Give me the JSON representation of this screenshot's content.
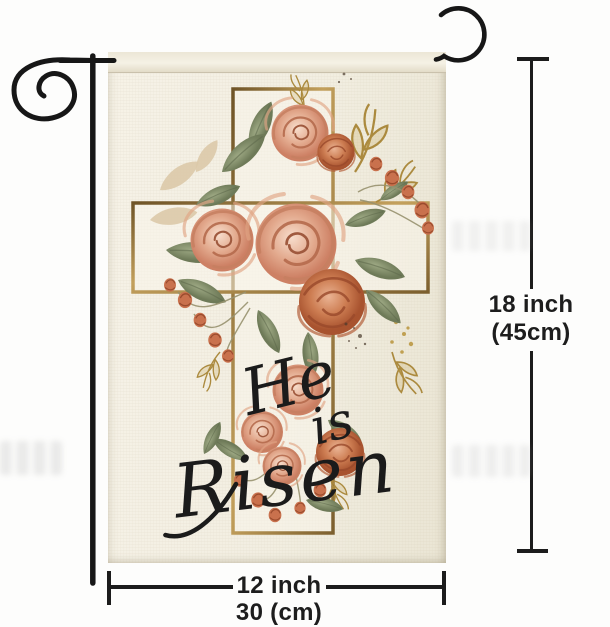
{
  "product": {
    "type": "garden-flag-with-stand",
    "flag_text": {
      "line1": "He",
      "line2": "is",
      "line3": "Risen"
    },
    "artwork": "watercolor floral cross with roses, sage leaves and gold sprigs",
    "colors": {
      "background": "#fdfdfc",
      "flag_fabric": "#f2eee1",
      "stand_black": "#171717",
      "cross_gold": "#9c7a44",
      "rose_pink": "#dc9f86",
      "rose_terracotta": "#c06a46",
      "leaf_sage": "#879274",
      "gold_accent": "#ab8a3e",
      "script_text": "#1b1b1b",
      "dimension_line": "#1c1c1c"
    }
  },
  "annotations": {
    "height": {
      "line1": "18 inch",
      "line2": "(45cm)"
    },
    "width": {
      "line1": "12 inch",
      "line2": "30 (cm)"
    }
  }
}
